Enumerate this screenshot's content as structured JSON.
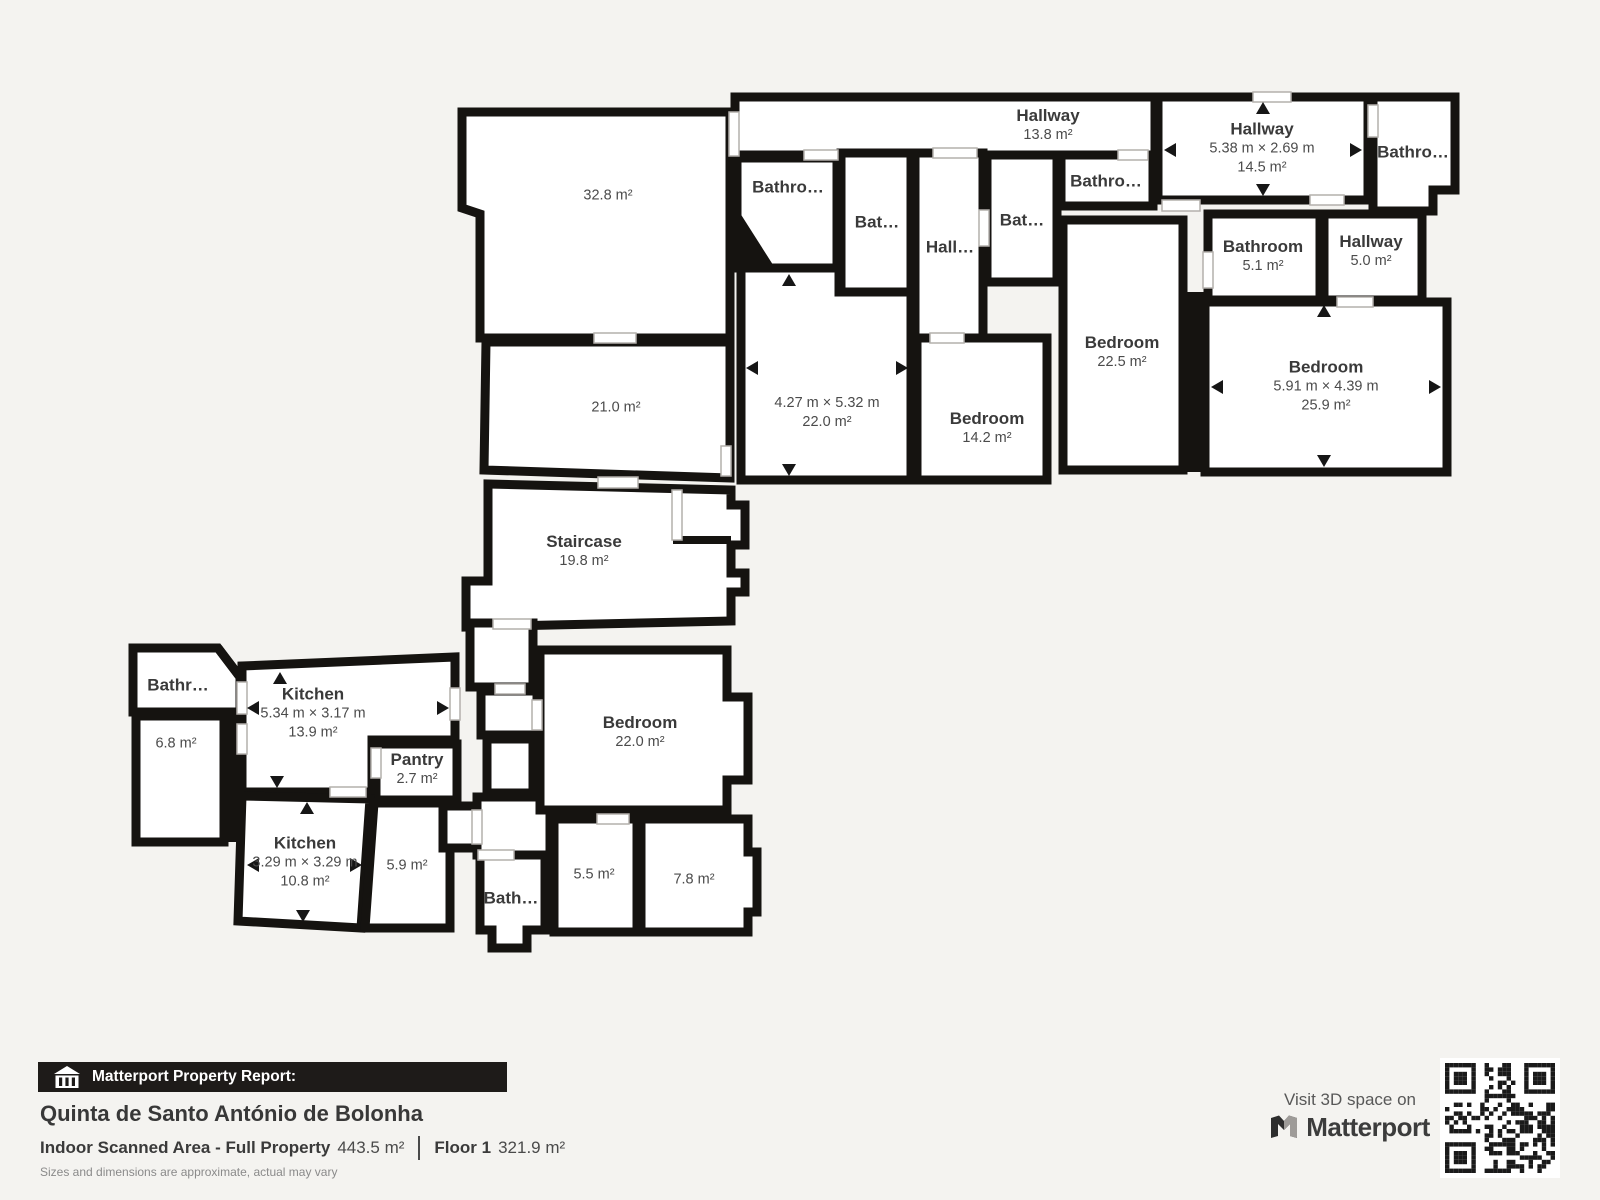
{
  "rooms": [
    {
      "name": "Hallway",
      "area": "13.8 m²"
    },
    {
      "name": "Hallway",
      "dims": "5.38 m × 2.69 m",
      "area": "14.5 m²"
    },
    {
      "name": "Bathro…"
    },
    {
      "name": "Bathro…"
    },
    {
      "name": "Bat…"
    },
    {
      "name": "Hall…"
    },
    {
      "name": "Bat…"
    },
    {
      "name": "Bathro…"
    },
    {
      "name": "Bathroom",
      "area": "5.1 m²"
    },
    {
      "name": "Hallway",
      "area": "5.0 m²"
    },
    {
      "name": "Bedroom",
      "area": "22.5 m²"
    },
    {
      "name": "Bedroom",
      "dims": "5.91 m × 4.39 m",
      "area": "25.9 m²"
    },
    {
      "dims": "4.27 m × 5.32 m",
      "area": "22.0 m²"
    },
    {
      "name": "Bedroom",
      "area": "14.2 m²"
    },
    {
      "area": "32.8 m²"
    },
    {
      "area": "21.0 m²"
    },
    {
      "name": "Staircase",
      "area": "19.8 m²"
    },
    {
      "name": "Bathr…"
    },
    {
      "area": "6.8 m²"
    },
    {
      "name": "Kitchen",
      "dims": "5.34 m × 3.17 m",
      "area": "13.9 m²"
    },
    {
      "name": "Pantry",
      "area": "2.7 m²"
    },
    {
      "name": "Kitchen",
      "dims": "3.29 m × 3.29 m",
      "area": "10.8 m²"
    },
    {
      "area": "5.9 m²"
    },
    {
      "name": "Bedroom",
      "area": "22.0 m²"
    },
    {
      "name": "Bath…"
    },
    {
      "area": "5.5 m²"
    },
    {
      "area": "7.8 m²"
    }
  ],
  "footer": {
    "report_label": "Matterport Property Report:",
    "property_name": "Quinta de Santo António de Bolonha",
    "scanned_area_label": "Indoor Scanned Area - Full Property",
    "scanned_area_value": "443.5 m²",
    "floor_label": "Floor 1",
    "floor_value": "321.9 m²",
    "disclaimer": "Sizes and dimensions are approximate, actual may vary",
    "visit_label": "Visit 3D space on",
    "brand": "Matterport"
  },
  "colors": {
    "wall": "#151310",
    "room_fill": "#ffffff",
    "background": "#f4f3f0",
    "banner_bg": "#1e1b19"
  }
}
